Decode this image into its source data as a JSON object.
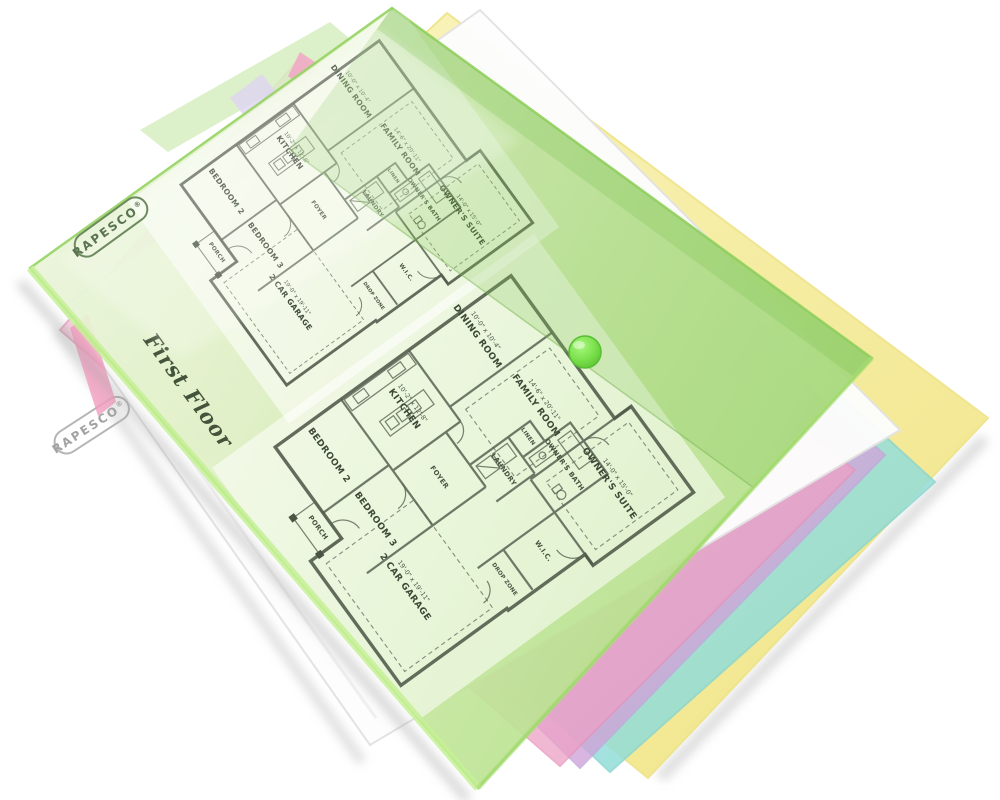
{
  "branding": {
    "logo_text": "RAPESCO",
    "registered_mark": "®"
  },
  "plan": {
    "title": "First Floor",
    "rooms": [
      {
        "label": "DINING ROOM",
        "dim": "10'-0\" x 10'-4\""
      },
      {
        "label": "KITCHEN",
        "dim": "10'-2\" x 12'-8\""
      },
      {
        "label": "FAMILY ROOM",
        "dim": "14'-6\" x 20'-11\""
      },
      {
        "label": "BEDROOM 2",
        "dim": ""
      },
      {
        "label": "BEDROOM 3",
        "dim": ""
      },
      {
        "label": "2 CAR GARAGE",
        "dim": "19'-0\" x 19'-11\""
      },
      {
        "label": "OWNER'S SUITE",
        "dim": "14'-0\" x 15'-0\""
      },
      {
        "label": "OWNER'S BATH",
        "dim": ""
      },
      {
        "label": "W.I.C.",
        "dim": ""
      },
      {
        "label": "LAUNDRY",
        "dim": ""
      },
      {
        "label": "FOYER",
        "dim": ""
      },
      {
        "label": "PORCH",
        "dim": ""
      },
      {
        "label": "LINEN",
        "dim": ""
      },
      {
        "label": "DROP ZONE",
        "dim": ""
      }
    ]
  },
  "folders": [
    {
      "name": "green-wallet",
      "color": "#cdeaa8"
    },
    {
      "name": "clear-wallet",
      "color": "#fbfbfb"
    },
    {
      "name": "pink-wallet",
      "color": "#f3b9d2"
    },
    {
      "name": "purple-wallet",
      "color": "#ccc0ea"
    },
    {
      "name": "cyan-wallet",
      "color": "#a8e4db"
    },
    {
      "name": "yellow-wallet",
      "color": "#f6ee9f"
    }
  ],
  "snap_button_color": "#7ee24f"
}
